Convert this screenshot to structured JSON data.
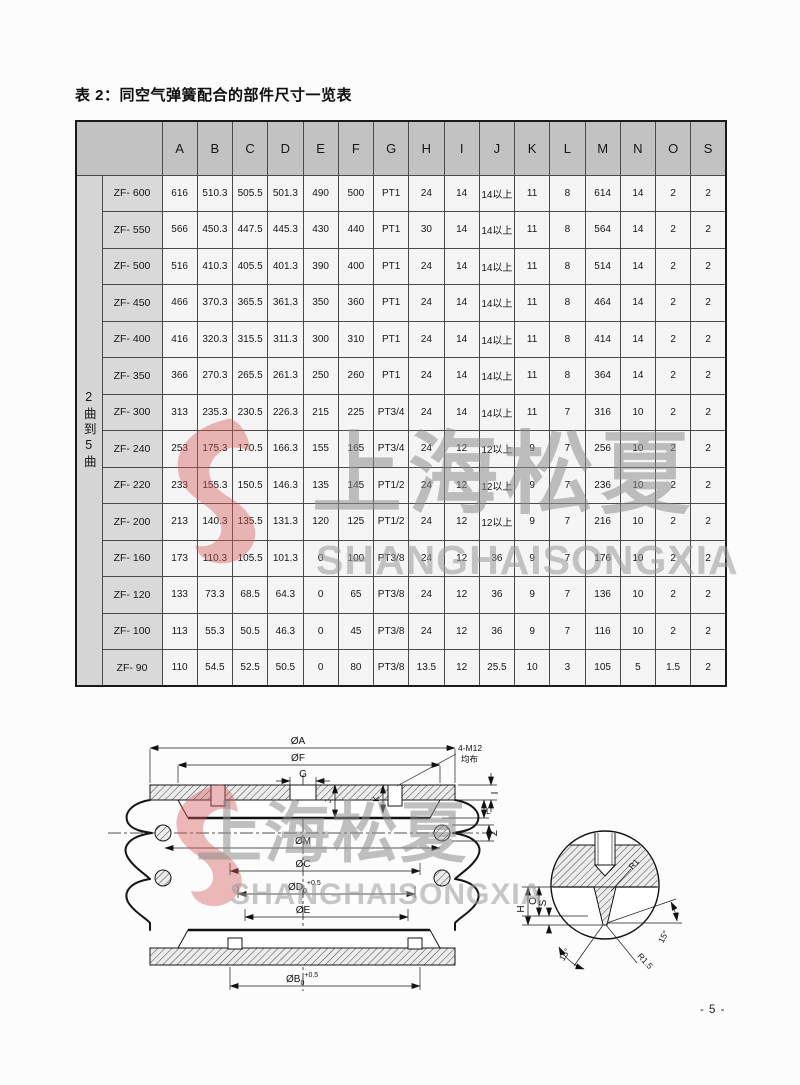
{
  "page": {
    "title": "表 2：同空气弹簧配合的部件尺寸一览表",
    "page_number": "- 5 -"
  },
  "watermark": {
    "cn": "上海松夏",
    "en": "SHANGHAISONGXIA",
    "logo_color": "#d4595a"
  },
  "table": {
    "side_label": "2曲到5曲",
    "columns": [
      "A",
      "B",
      "C",
      "D",
      "E",
      "F",
      "G",
      "H",
      "I",
      "J",
      "K",
      "L",
      "M",
      "N",
      "O",
      "S"
    ],
    "rows": [
      {
        "model": "ZF- 600",
        "values": [
          "616",
          "510.3",
          "505.5",
          "501.3",
          "490",
          "500",
          "PT1",
          "24",
          "14",
          "14以上",
          "11",
          "8",
          "614",
          "14",
          "2",
          "2"
        ]
      },
      {
        "model": "ZF- 550",
        "values": [
          "566",
          "450.3",
          "447.5",
          "445.3",
          "430",
          "440",
          "PT1",
          "30",
          "14",
          "14以上",
          "11",
          "8",
          "564",
          "14",
          "2",
          "2"
        ]
      },
      {
        "model": "ZF- 500",
        "values": [
          "516",
          "410.3",
          "405.5",
          "401.3",
          "390",
          "400",
          "PT1",
          "24",
          "14",
          "14以上",
          "11",
          "8",
          "514",
          "14",
          "2",
          "2"
        ]
      },
      {
        "model": "ZF- 450",
        "values": [
          "466",
          "370.3",
          "365.5",
          "361.3",
          "350",
          "360",
          "PT1",
          "24",
          "14",
          "14以上",
          "11",
          "8",
          "464",
          "14",
          "2",
          "2"
        ]
      },
      {
        "model": "ZF- 400",
        "values": [
          "416",
          "320.3",
          "315.5",
          "311.3",
          "300",
          "310",
          "PT1",
          "24",
          "14",
          "14以上",
          "11",
          "8",
          "414",
          "14",
          "2",
          "2"
        ]
      },
      {
        "model": "ZF- 350",
        "values": [
          "366",
          "270.3",
          "265.5",
          "261.3",
          "250",
          "260",
          "PT1",
          "24",
          "14",
          "14以上",
          "11",
          "8",
          "364",
          "14",
          "2",
          "2"
        ]
      },
      {
        "model": "ZF- 300",
        "values": [
          "313",
          "235.3",
          "230.5",
          "226.3",
          "215",
          "225",
          "PT3/4",
          "24",
          "14",
          "14以上",
          "11",
          "7",
          "316",
          "10",
          "2",
          "2"
        ]
      },
      {
        "model": "ZF- 240",
        "values": [
          "253",
          "175.3",
          "170.5",
          "166.3",
          "155",
          "165",
          "PT3/4",
          "24",
          "12",
          "12以上",
          "9",
          "7",
          "256",
          "10",
          "2",
          "2"
        ]
      },
      {
        "model": "ZF- 220",
        "values": [
          "233",
          "155.3",
          "150.5",
          "146.3",
          "135",
          "145",
          "PT1/2",
          "24",
          "12",
          "12以上",
          "9",
          "7",
          "236",
          "10",
          "2",
          "2"
        ]
      },
      {
        "model": "ZF- 200",
        "values": [
          "213",
          "140.3",
          "135.5",
          "131.3",
          "120",
          "125",
          "PT1/2",
          "24",
          "12",
          "12以上",
          "9",
          "7",
          "216",
          "10",
          "2",
          "2"
        ]
      },
      {
        "model": "ZF- 160",
        "values": [
          "173",
          "110.3",
          "105.5",
          "101.3",
          "0",
          "100",
          "PT3/8",
          "24",
          "12",
          "36",
          "9",
          "7",
          "176",
          "10",
          "2",
          "2"
        ]
      },
      {
        "model": "ZF- 120",
        "values": [
          "133",
          "73.3",
          "68.5",
          "64.3",
          "0",
          "65",
          "PT3/8",
          "24",
          "12",
          "36",
          "9",
          "7",
          "136",
          "10",
          "2",
          "2"
        ]
      },
      {
        "model": "ZF- 100",
        "values": [
          "113",
          "55.3",
          "50.5",
          "46.3",
          "0",
          "45",
          "PT3/8",
          "24",
          "12",
          "36",
          "9",
          "7",
          "116",
          "10",
          "2",
          "2"
        ]
      },
      {
        "model": "ZF- 90",
        "values": [
          "110",
          "54.5",
          "52.5",
          "50.5",
          "0",
          "80",
          "PT3/8",
          "13.5",
          "12",
          "25.5",
          "10",
          "3",
          "105",
          "5",
          "1.5",
          "2"
        ]
      }
    ]
  },
  "drawing": {
    "labels": {
      "oa": "ØA",
      "of": "ØF",
      "g": "G",
      "bolt_callout": "4-M12",
      "bolt_callout2": "均布",
      "i": "I",
      "l": "L",
      "z": "Z",
      "j": "J",
      "k": "K",
      "om": "ØM",
      "oc": "ØC",
      "od_base": "ØD",
      "od_sub": "0",
      "od_sup": "+0.5",
      "oe": "ØE",
      "ob_base": "ØB",
      "ob_sub": "0",
      "ob_sup": "+0.5",
      "h": "H",
      "o": "O",
      "s": "S",
      "r1": "R1",
      "r1_5": "R1.5",
      "angle_left": "15°",
      "angle_right": "15°"
    }
  }
}
